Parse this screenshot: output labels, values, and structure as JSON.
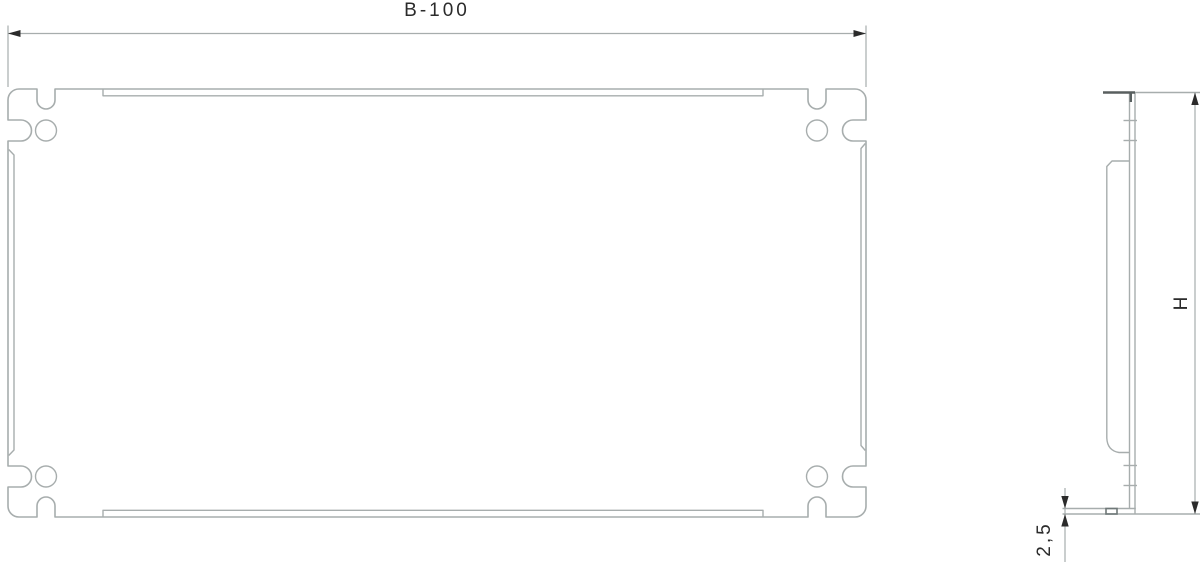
{
  "drawing": {
    "type": "technical-drawing",
    "subject": "enclosure mounting plate, front view and side profile view",
    "background": "#ffffff",
    "line_color": "#a7adad",
    "accent_color": "#2b2b2b",
    "front_view": {
      "name": "front-view",
      "width_dimension_label": "B-100",
      "features": "four corner mounting holes, four U-notches on top and bottom edges, four side slots, hemmed edges"
    },
    "side_view": {
      "name": "side-profile-view",
      "height_dimension_label": "H",
      "thickness_dimension_label": "2,5"
    }
  }
}
